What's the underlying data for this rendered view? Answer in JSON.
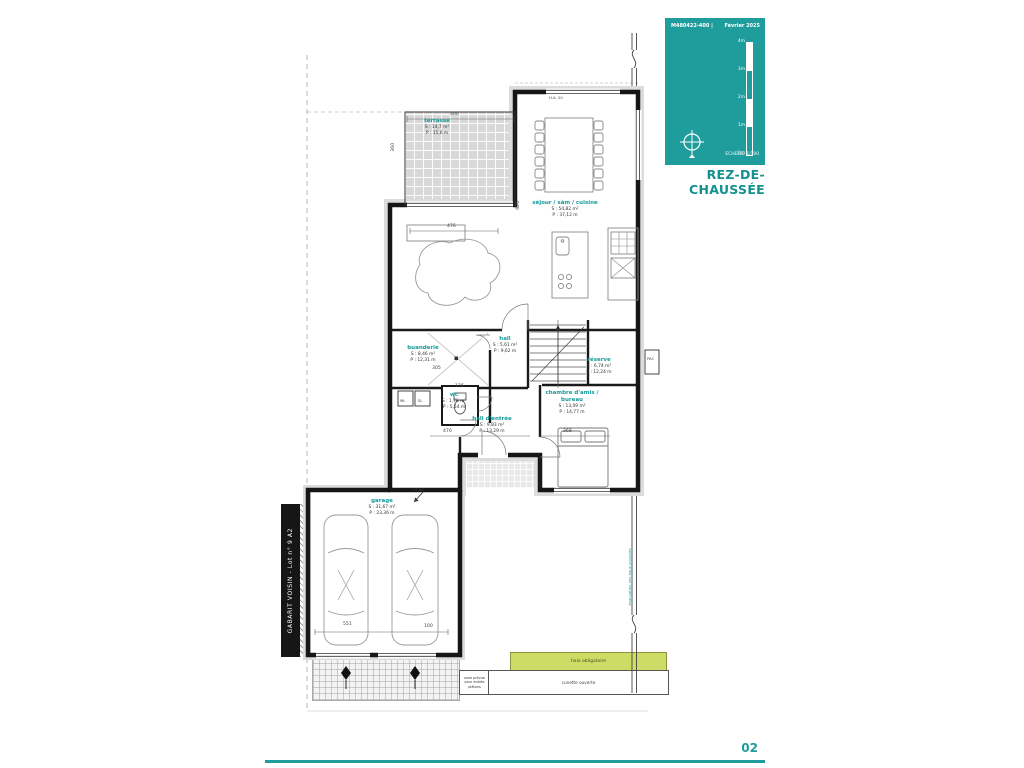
{
  "title_block": {
    "ref": "M480422-400  |",
    "date": "Février 2025",
    "scale_ticks": [
      "4m",
      "3m",
      "2m",
      "1m",
      "0m"
    ],
    "scale_label": "ECHELLE   1/100",
    "floor_title": "REZ-DE-CHAUSSÉE"
  },
  "footer": {
    "page_number": "02"
  },
  "side_label": "GABARIT VOISIN - Lot n° 9 A2",
  "rooms": [
    {
      "name": "terrasse",
      "s": "S : 14,7 m²",
      "p": "P : 15,6 m"
    },
    {
      "name": "séjour / sàm / cuisine",
      "s": "S : 54,82 m²",
      "p": "P : 37,12 m"
    },
    {
      "name": "buanderie",
      "s": "S : 8,46 m²",
      "p": "P : 12,31 m"
    },
    {
      "name": "hall",
      "s": "S : 5,61 m²",
      "p": "P : 9,62 m"
    },
    {
      "name": "réserve",
      "s": "S : 6,74 m²",
      "p": "P : 12,24 m"
    },
    {
      "name": "wc",
      "s": "S : 1,76 m²",
      "p": "P : 5,54 m"
    },
    {
      "name": "hall d'entrée",
      "s": "S : 9,83 m²",
      "p": "P : 13,29 m"
    },
    {
      "name": "chambre d'amis / bureau",
      "s": "S : 13,09 m²",
      "p": "P : 14,77 m"
    },
    {
      "name": "garage",
      "s": "S : 31,67 m²",
      "p": "P : 23,36 m"
    }
  ],
  "dimensions": {
    "terrace_w": "400",
    "terrace_h": "360",
    "living_w": "476",
    "kitchen_h": "620",
    "buanderie_w": "305",
    "wc_w": "176",
    "entry_w": "476",
    "chambre_w": "368",
    "garage_w": "551",
    "garage_off": "100"
  },
  "small_labels": {
    "ml": "ML",
    "sl": "SL",
    "pac": "PAC",
    "ha": "H.A. 20",
    "level": "+0,00"
  },
  "annotations": {
    "haie": "haie obligatoire",
    "cunette": "cunette ouverte",
    "pedestrian": "zone prévue pour entrée piétons",
    "boundary": "évacuation des eaux pluviales"
  },
  "colors": {
    "teal": "#1f9c9c",
    "green": "#cddc64",
    "wall": "#161616"
  }
}
